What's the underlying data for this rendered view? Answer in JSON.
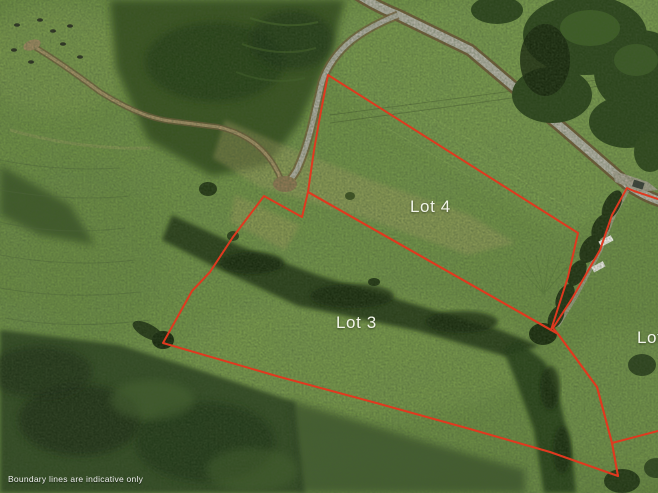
{
  "map": {
    "title": "Aerial parcel map",
    "width": 658,
    "height": 493,
    "disclaimer": "Boundary lines are indicative only",
    "boundary_style": {
      "color": "#e0391f",
      "width": 2
    },
    "lots": [
      {
        "id": "lot-4",
        "label": "Lot 4",
        "label_x": 410,
        "label_y": 197
      },
      {
        "id": "lot-3",
        "label": "Lot 3",
        "label_x": 336,
        "label_y": 313
      },
      {
        "id": "lot-right",
        "label": "Lot",
        "label_x": 637,
        "label_y": 328
      }
    ],
    "boundaries": [
      {
        "name": "lot-4-boundary",
        "closed": true,
        "points": "328,75 578,233 568,277 551,330 308,192 314,150 321,111"
      },
      {
        "name": "lot-3-boundary",
        "closed": true,
        "points": "308,192 302,217 264,196 233,237 210,272 192,291 163,343 280,377 380,404 470,429 550,452 618,476 612,443 597,387 558,334 551,330"
      },
      {
        "name": "lot-right-west-boundary",
        "closed": false,
        "points": "658,199 634,191 627,188 612,215 600,250 573,297 553,328 558,334 597,387 612,443 618,476"
      },
      {
        "name": "lot-right-south-boundary",
        "closed": false,
        "points": "612,443 658,431"
      }
    ]
  }
}
